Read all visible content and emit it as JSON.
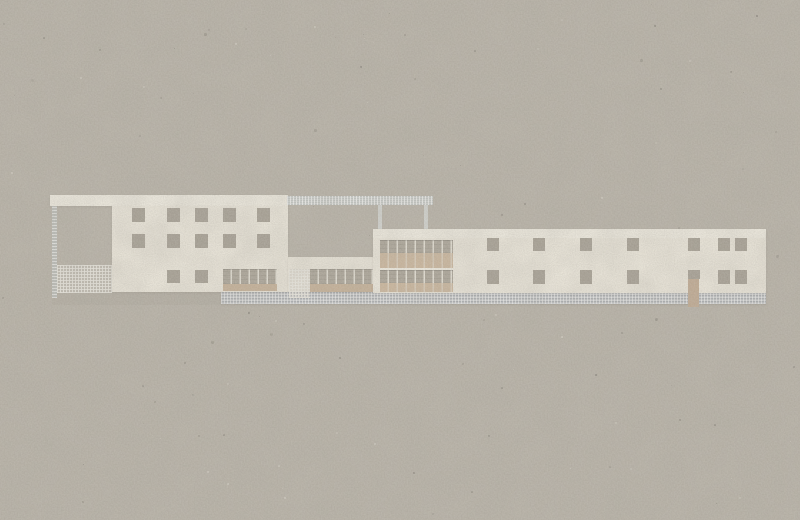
{
  "scene": {
    "kind": "architectural elevation collage",
    "medium": "cut-paper collage on gray cardboard, no text or labels",
    "subject": "long low modernist building: left block with window grid and pergola frame, low connecting wing with ribbon glazing and mesh gate, right block with curtain-wall section, window rows and entrance door"
  },
  "palette": {
    "paper": "#b1ab9f",
    "cream_light": "#f6f2e6",
    "cream": "#f1ecdf",
    "cream_right": "#f2ede0",
    "window": "#9a9386",
    "window_dark": "#8e887b",
    "tan": "#c9b092",
    "tan_sill": "#c3a98b",
    "door": "#bca184",
    "post_silver": "#d2d5d2",
    "ground": "#a69f94"
  },
  "elements": {
    "base": {
      "ground_strip": {
        "x": 52,
        "y": 292,
        "w": 714,
        "h": 13
      },
      "plinth": {
        "x": 221,
        "y": 292,
        "w": 545,
        "h": 12
      }
    },
    "pergola": {
      "top_band": {
        "x": 50,
        "y": 195,
        "w": 238,
        "h": 11
      },
      "column": {
        "x": 52,
        "y": 206,
        "w": 5,
        "h": 92
      },
      "mesh_fence": {
        "x": 57,
        "y": 265,
        "w": 55,
        "h": 28
      }
    },
    "left_block": {
      "face": {
        "x": 112,
        "y": 206,
        "w": 176,
        "h": 86
      },
      "window_w": 13,
      "window_h": 14,
      "window_rows": [
        {
          "y": 208,
          "h": 14,
          "cols": [
            132,
            167,
            195,
            223,
            257
          ]
        },
        {
          "y": 234,
          "h": 14,
          "cols": [
            132,
            167,
            195,
            223,
            257
          ]
        },
        {
          "y": 270,
          "h": 13,
          "cols": [
            167,
            195
          ]
        }
      ],
      "ribbon": {
        "x": 223,
        "y": 269,
        "w": 54,
        "h": 15
      },
      "sill": {
        "x": 223,
        "y": 284,
        "w": 54,
        "h": 7
      }
    },
    "wing": {
      "face": {
        "x": 288,
        "y": 257,
        "w": 85,
        "h": 35
      },
      "ribbon": {
        "x": 310,
        "y": 269,
        "w": 72,
        "h": 15
      },
      "sill": {
        "x": 310,
        "y": 284,
        "w": 72,
        "h": 8
      },
      "mesh_gate": {
        "x": 289,
        "y": 269,
        "w": 21,
        "h": 29
      }
    },
    "roof_frame": {
      "beam": {
        "x": 287,
        "y": 196,
        "w": 146,
        "h": 9
      },
      "posts": [
        {
          "x": 378,
          "y": 205,
          "w": 4,
          "h": 24
        },
        {
          "x": 424,
          "y": 205,
          "w": 4,
          "h": 24
        }
      ]
    },
    "right_block": {
      "face": {
        "x": 373,
        "y": 229,
        "w": 393,
        "h": 64
      },
      "top_band": {
        "x": 373,
        "y": 229,
        "w": 393,
        "h": 9
      },
      "curtain_wall": {
        "x": 380,
        "w": 73,
        "strips": [
          {
            "y": 240,
            "h": 13,
            "type": "glazing"
          },
          {
            "y": 253,
            "h": 15,
            "type": "tan"
          },
          {
            "y": 268,
            "h": 2,
            "type": "white"
          },
          {
            "y": 270,
            "h": 13,
            "type": "glazing"
          },
          {
            "y": 283,
            "h": 9,
            "type": "tan"
          }
        ]
      },
      "window_w": 12,
      "window_h": 13,
      "window_rows": [
        {
          "y": 238,
          "h": 13,
          "cols": [
            487,
            533,
            580,
            627,
            688,
            718,
            735
          ]
        },
        {
          "y": 270,
          "h": 14,
          "cols": [
            487,
            533,
            580,
            627,
            718,
            735
          ]
        },
        {
          "y": 270,
          "h": 9,
          "cols": [
            688
          ]
        }
      ],
      "door": {
        "x": 688,
        "y": 279,
        "w": 11,
        "h": 28
      }
    }
  }
}
